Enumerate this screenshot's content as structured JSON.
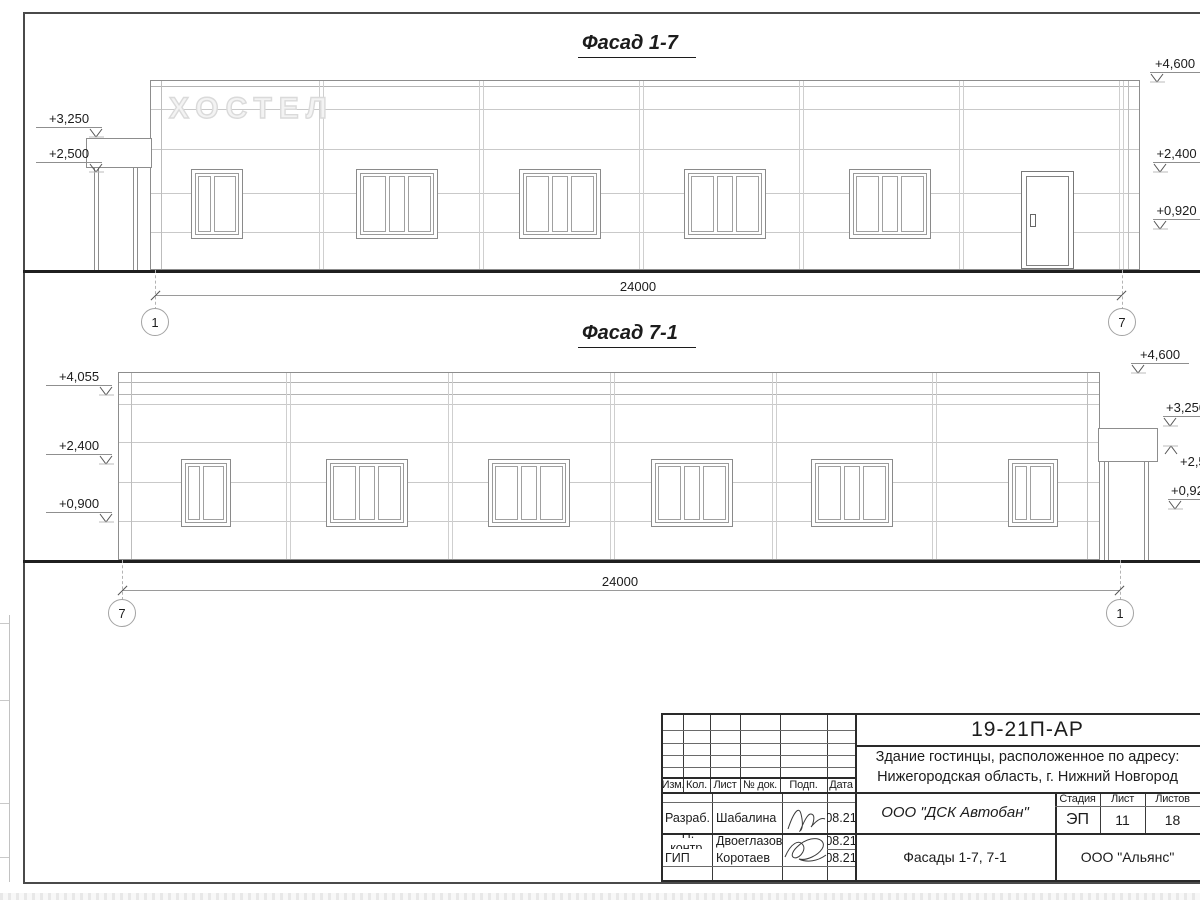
{
  "facade1": {
    "title": "Фасад 1-7",
    "sign": "ХОСТЕЛ",
    "marks_left": [
      "+3,250",
      "+2,500"
    ],
    "marks_right": [
      "+4,600",
      "+2,400",
      "+0,920"
    ],
    "dim": "24000",
    "axis_left": "1",
    "axis_right": "7"
  },
  "facade2": {
    "title": "Фасад 7-1",
    "marks_left": [
      "+4,055",
      "+2,400",
      "+0,900"
    ],
    "marks_right": [
      "+4,600",
      "+3,250",
      "+2,500",
      "+0,920"
    ],
    "dim": "24000",
    "axis_left": "7",
    "axis_right": "1"
  },
  "titleblock": {
    "doc_number": "19-21П-АР",
    "project_address_line1": "Здание гостинцы, расположенное по адресу:",
    "project_address_line2": "Нижегородская область, г. Нижний Новгород",
    "columns": [
      "Изм.",
      "Кол.",
      "Лист",
      "№ док.",
      "Подп.",
      "Дата"
    ],
    "rows": [
      {
        "role": "Разраб.",
        "name": "Шабалина",
        "date": "08.21"
      },
      {
        "role": "Н. контр.",
        "name": "Двоеглазов",
        "date": "08.21"
      },
      {
        "role": "ГИП",
        "name": "Коротаев",
        "date": "08.21"
      }
    ],
    "contractor": "ООО \"ДСК Автобан\"",
    "sheet_name": "Фасады 1-7, 7-1",
    "organization": "ООО \"Альянс\"",
    "stage_label": "Стадия",
    "stage_value": "ЭП",
    "sheet_label": "Лист",
    "sheet_value": "11",
    "sheets_label": "Листов",
    "sheets_value": "18"
  }
}
